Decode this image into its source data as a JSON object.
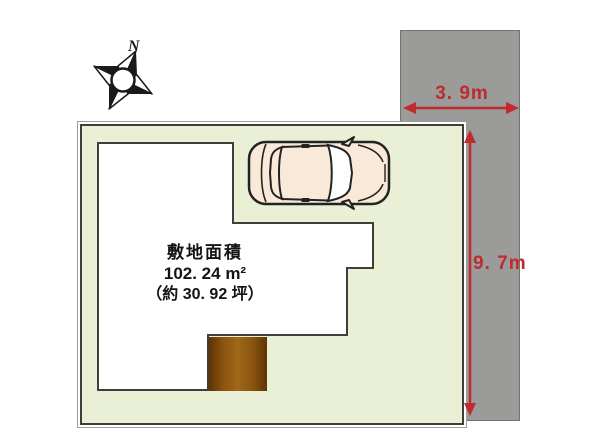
{
  "diagram": {
    "type": "real-estate site plan",
    "compass": {
      "north_label": "N"
    },
    "site_area": {
      "title": "敷地面積",
      "area_sqm": "102. 24 m²",
      "area_tsubo": "（約 30. 92 坪）"
    },
    "dimensions": {
      "width_label": "3. 9m",
      "depth_label": "9. 7m"
    },
    "colors": {
      "plot_green": "#e9f0d6",
      "road_gray": "#9b9b99",
      "outline_dark": "#3e3e3a",
      "dimension_red": "#bf2b30",
      "porch_brown": "#8a5410",
      "car_body": "#f8e9d8"
    }
  }
}
